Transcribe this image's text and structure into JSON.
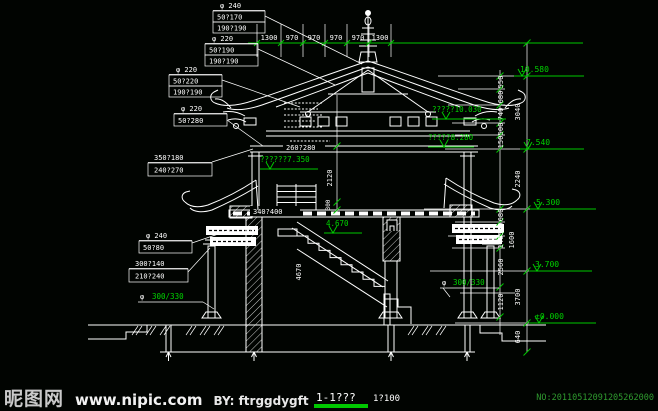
{
  "colors": {
    "green": "#00c800",
    "text_green": "#00d400",
    "line_white": "#ffffff",
    "serial_green": "#2f9b2f"
  },
  "top_dims": [
    "1300",
    "970",
    "970",
    "970",
    "970",
    "1300"
  ],
  "boxes": {
    "a": {
      "r1": "φ  240",
      "r2": "50?170",
      "r3": "190?190"
    },
    "b": {
      "r1": "φ  220",
      "r2": "50?190",
      "r3": "190?190"
    },
    "c": {
      "r1": "φ  220",
      "r2": "50?220",
      "r3": "190?190"
    },
    "d": {
      "r1": "φ  220",
      "r2": "50?280"
    },
    "e": {
      "r1": "350?180",
      "r2": "240?270"
    },
    "f": {
      "r1": "φ  240",
      "r2": "50?80"
    },
    "g": {
      "r1": "300?140",
      "r2": "210?240"
    }
  },
  "columns": {
    "prefix": "φ",
    "size": "300/330"
  },
  "elevations": {
    "top": "10.580",
    "roof_upper": "?????10.030",
    "roof_lower": "?????8.280",
    "eave": "7.540",
    "floor2": "??????7.350",
    "balcony": "5.300",
    "stair": "4.670",
    "window": "3.700",
    "ground": "±0.000"
  },
  "vdims": {
    "a": "550",
    "b": "680",
    "c": "740",
    "d": "500",
    "e": "150",
    "roof_total": "3040",
    "upper_total": "2240",
    "f": "680",
    "g": "500",
    "h": "140",
    "mid_total": "1600",
    "i": "2560",
    "j": "1120",
    "lower_total": "3700",
    "k": "640",
    "center": "2120",
    "center_small": "300",
    "stairs": "4670"
  },
  "inline": {
    "beam": "260?280",
    "floor_beam": "340?400"
  },
  "title": {
    "label": "1-1???",
    "scale": "1?100"
  },
  "watermark": {
    "site": "昵图网",
    "url": "www.nipic.com",
    "credit": "BY: ftrggdygft",
    "serial": "NO:20110512091205262000"
  }
}
